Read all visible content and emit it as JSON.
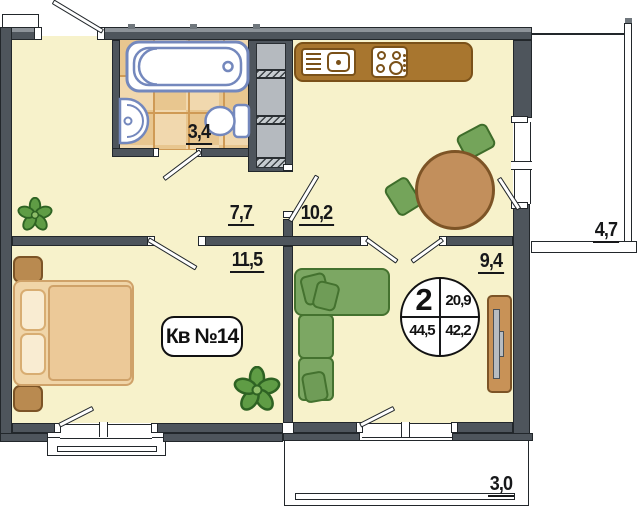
{
  "plan": {
    "apartment_label": "Кв №14",
    "info_circle": {
      "rooms_count": "2",
      "kitchen_area": "20,9",
      "total_area": "44,5",
      "living_area": "42,2"
    },
    "rooms": {
      "bathroom": {
        "area": "3,4"
      },
      "hallway": {
        "area": "7,7"
      },
      "kitchen": {
        "area": "10,2"
      },
      "bedroom": {
        "area": "11,5"
      },
      "living_room": {
        "area": "9,4"
      },
      "balcony_right": {
        "area": "4,7"
      },
      "balcony_bottom": {
        "area": "3,0"
      }
    },
    "colors": {
      "wall": "#4e555c",
      "floor": "#f7f2cb",
      "tile": "#eecf9e",
      "fixture_outline": "#7488bd",
      "counter_brown": "#a8762f",
      "table_wood": "#c28f5c",
      "chair_green": "#74a45a",
      "sofa_green": "#7ca763",
      "bed_tan": "#f0d5a8",
      "plant_green": "#5f9c45"
    }
  }
}
